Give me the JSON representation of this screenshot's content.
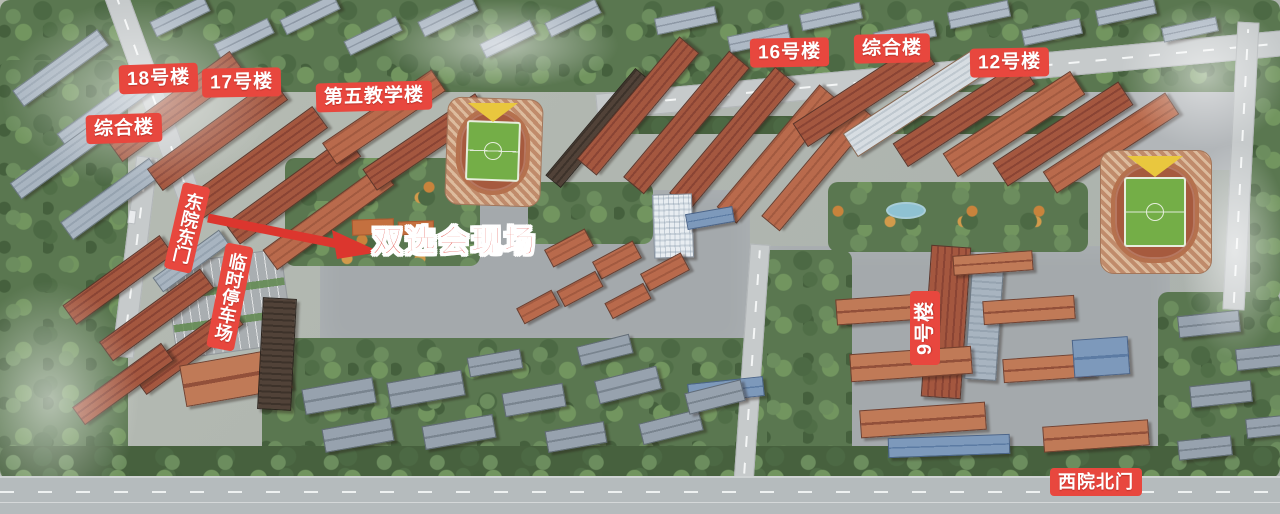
{
  "colors": {
    "badge_red": "#e8473e",
    "arrow_red": "#dc362e",
    "label_text": "#ffffff"
  },
  "labels": {
    "building_18": "18号楼",
    "building_17": "17号楼",
    "complex_left": "综合楼",
    "teaching_5": "第五教学楼",
    "east_gate": "东院东门",
    "temp_parking": "临时停车场",
    "event_site": "双选会现场",
    "building_16": "16号楼",
    "complex_right": "综合楼",
    "building_12": "12号楼",
    "building_9": "9号楼",
    "west_north_gate": "西院北门"
  }
}
